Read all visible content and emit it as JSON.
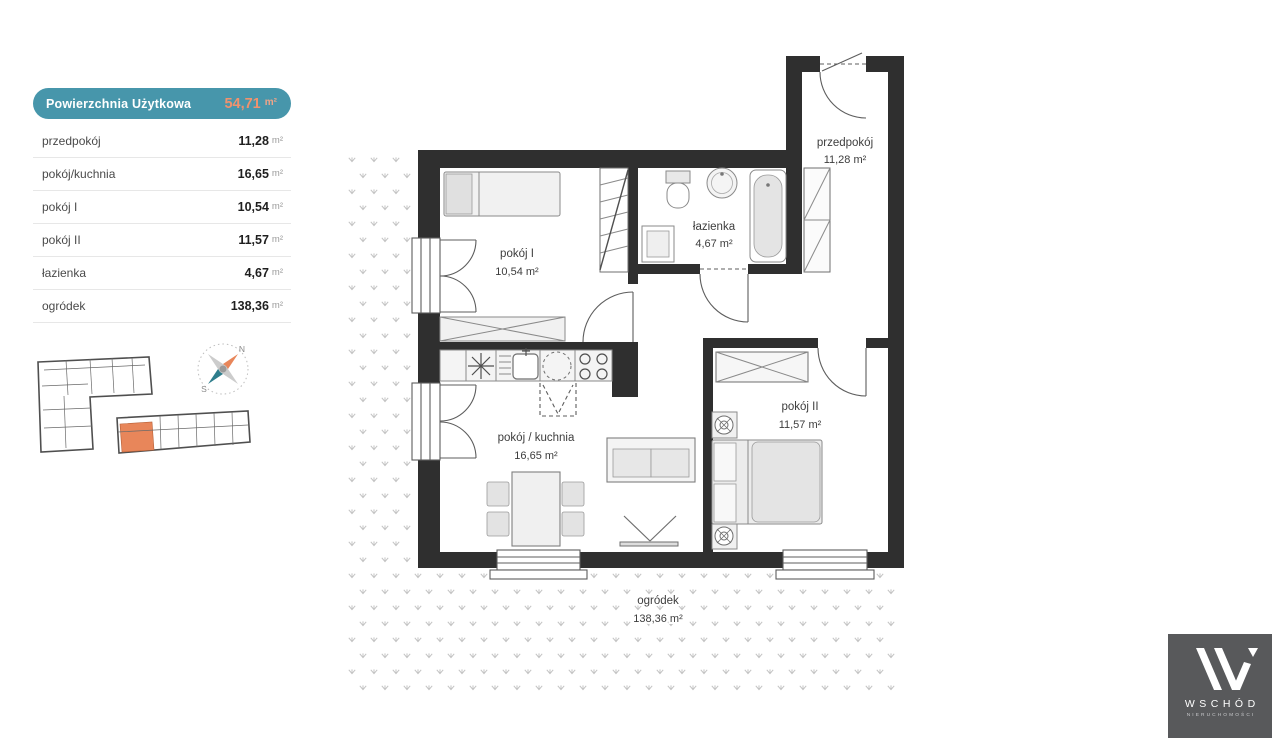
{
  "summary": {
    "title": "Powierzchnia Użytkowa",
    "total_value": "54,71",
    "unit_label": "m²",
    "rows": [
      {
        "label": "przedpokój",
        "value": "11,28"
      },
      {
        "label": "pokój/kuchnia",
        "value": "16,65"
      },
      {
        "label": "pokój I",
        "value": "10,54"
      },
      {
        "label": "pokój II",
        "value": "11,57"
      },
      {
        "label": "łazienka",
        "value": "4,67"
      },
      {
        "label": "ogródek",
        "value": "138,36"
      }
    ]
  },
  "plan": {
    "rooms": [
      {
        "id": "przedpokoj",
        "name": "przedpokój",
        "area": "11,28 m²"
      },
      {
        "id": "lazienka",
        "name": "łazienka",
        "area": "4,67 m²"
      },
      {
        "id": "pokoj1",
        "name": "pokój I",
        "area": "10,54 m²"
      },
      {
        "id": "pokoj_kuchnia",
        "name": "pokój / kuchnia",
        "area": "16,65 m²"
      },
      {
        "id": "pokoj2",
        "name": "pokój II",
        "area": "11,57 m²"
      }
    ],
    "garden": {
      "name": "ogródek",
      "area": "138,36 m²"
    }
  },
  "compass": {
    "north": "N",
    "south": "S"
  },
  "logo": {
    "brand": "WSCHÓD",
    "sub": "NIERUCHOMOŚCI"
  },
  "colors": {
    "accent_teal": "#4796ab",
    "accent_orange": "#f0926e",
    "highlight_unit": "#e8865a",
    "wall": "#2f2f2f",
    "logo_bg": "#58595b"
  }
}
